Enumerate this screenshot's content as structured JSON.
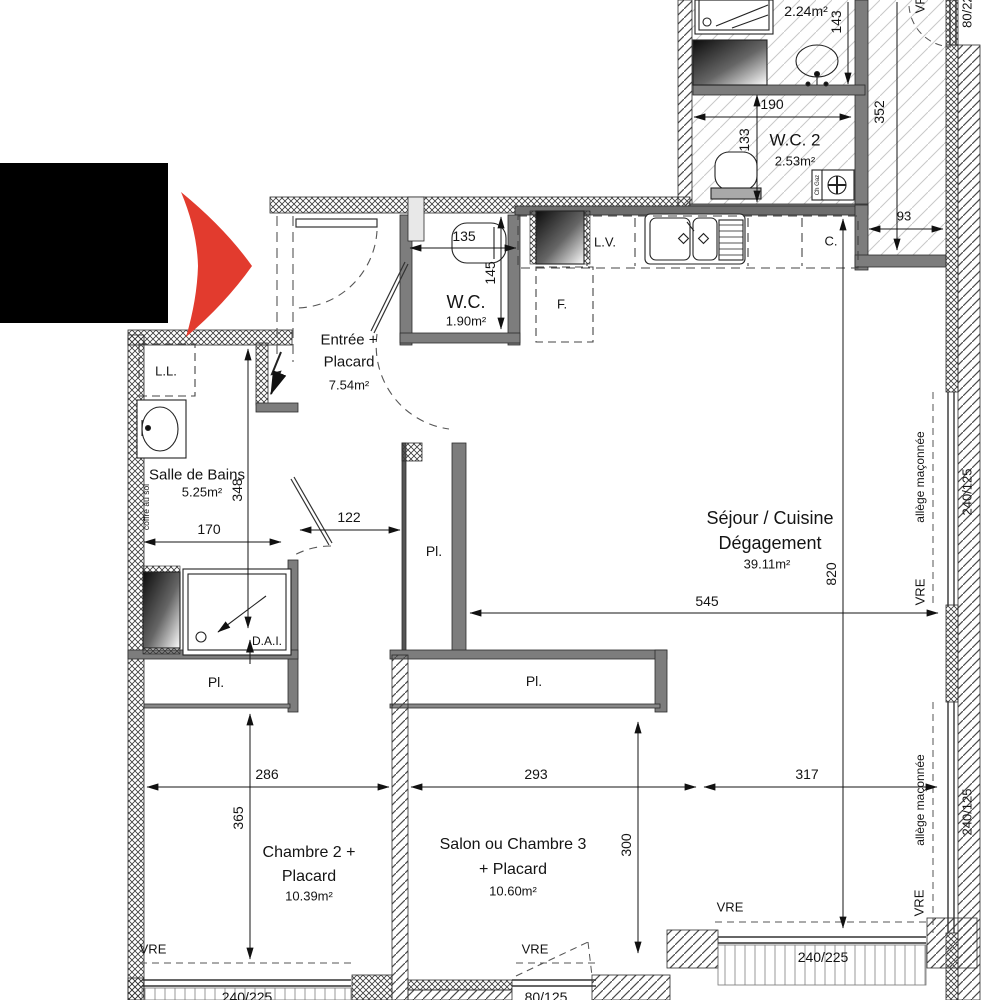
{
  "plan": {
    "rooms": {
      "shower_room": {
        "area": "2.24m²"
      },
      "wc2": {
        "name": "W.C. 2",
        "area": "2.53m²"
      },
      "wc1": {
        "name": "W.C.",
        "area": "1.90m²"
      },
      "entree": {
        "l1": "Entrée +",
        "l2": "Placard",
        "area": "7.54m²"
      },
      "bain": {
        "name": "Salle de Bains",
        "area": "5.25m²"
      },
      "sejour": {
        "l1": "Séjour / Cuisine",
        "l2": "Dégagement",
        "area": "39.11m²"
      },
      "chambre2": {
        "l1": "Chambre 2 +",
        "l2": "Placard",
        "area": "10.39m²"
      },
      "salon": {
        "l1": "Salon ou Chambre 3",
        "l2": "+ Placard",
        "area": "10.60m²"
      }
    },
    "fixtures": {
      "lave_linge": "L.L.",
      "lave_vaisselle": "L.V.",
      "cuisiniere": "C.",
      "frigo": "F.",
      "chaudiere_gaz": "Ch Gaz",
      "dai": "D.A.I.",
      "placard": "Pl.",
      "coffre": "coffre au sol"
    },
    "dims": {
      "d143": "143",
      "d190": "190",
      "d352": "352",
      "d133": "133",
      "d93": "93",
      "d135": "135",
      "d145": "145",
      "d348": "348",
      "d170": "170",
      "d122": "122",
      "d545": "545",
      "d820": "820",
      "d286": "286",
      "d365": "365",
      "d293": "293",
      "d300": "300",
      "d317": "317"
    },
    "windows": {
      "vre": "VRE",
      "allege": "allège maçonnée",
      "w80_225": "80/225",
      "w240_125": "240/125",
      "w240_225": "240/225",
      "w80_125": "80/125"
    }
  },
  "colors": {
    "wall": "#7d7d7d",
    "marker_red": "#e23b2e",
    "redaction": "#000000"
  }
}
